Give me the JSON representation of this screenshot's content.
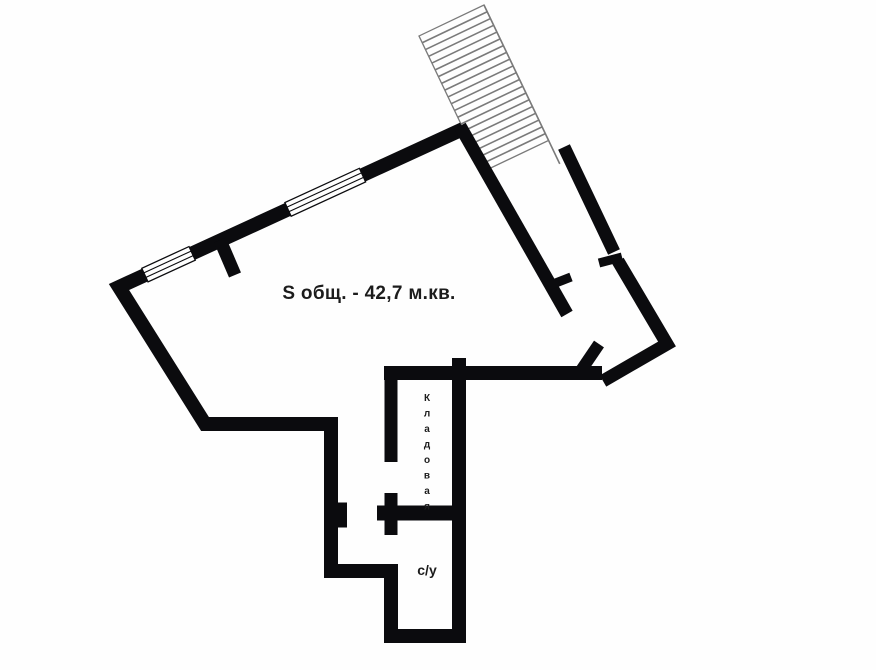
{
  "plan_labels": {
    "total_area": "S общ. - 42,7 м.кв.",
    "storage_room": "Кладовая",
    "bathroom": "с/у"
  },
  "staircase": {
    "steps": 19,
    "step_spacing": 7.5,
    "width": 72
  },
  "colors": {
    "wall": "#0b0b0e",
    "stair-line": "#7a7a7a",
    "background": "#fefefe",
    "text": "#1c1c1c"
  }
}
